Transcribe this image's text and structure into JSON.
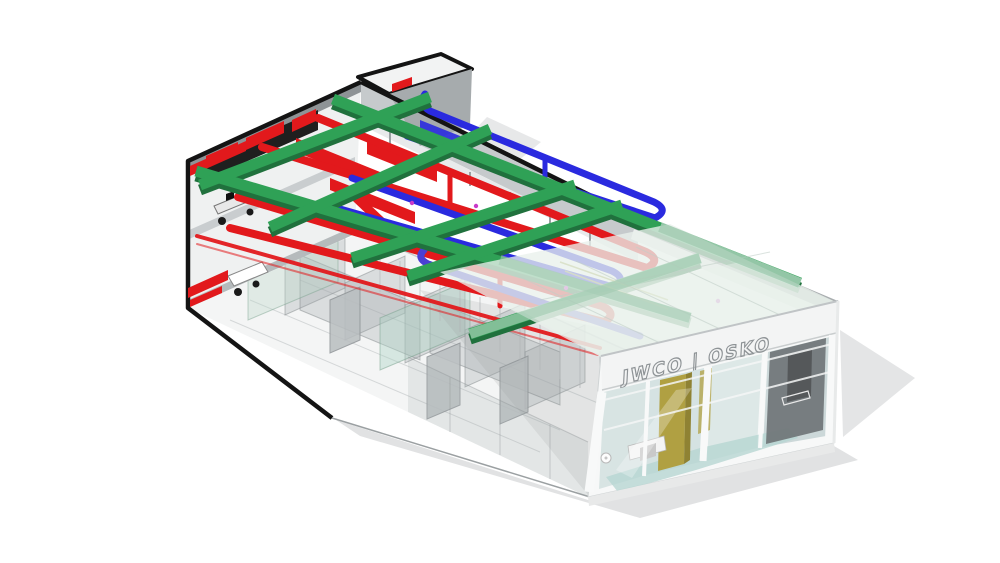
{
  "scene": {
    "background": "#ffffff",
    "description": "Axonometric cutaway BIM rendering of a commercial building with exposed structural beam grid, red ductwork and blue pipework over a ghosted interior, ending in a glazed storefront",
    "view": "isometric-cutaway"
  },
  "storefront": {
    "logo_text": "JWCO | OSKO"
  },
  "systems": {
    "structure": {
      "label": "beam-grid",
      "green": "#2FA156",
      "green_dark": "#20713D",
      "green_pale": "#A5CCB4"
    },
    "hvac": {
      "label": "ductwork",
      "red": "#E2191C"
    },
    "piping": {
      "label": "pipework",
      "blue": "#2A2ADF",
      "indigo": "#4A3FD4"
    },
    "shell": {
      "outline": "#141414",
      "wall": "#C6CACC",
      "parapet": "#A8ADAF",
      "poche": "#8E9396",
      "ceiling_void": "#1F1F1F"
    },
    "glazing": {
      "glass": "#D8E4E3",
      "roof_overlay": "#E9F1EC"
    },
    "finishes": {
      "olive": "#B0A042",
      "olive_dark": "#8F8233",
      "teal_floor": "#B7D6D2",
      "magenta_fixture": "#C93BC9",
      "cable_tray": "#9AA03A"
    },
    "ground": {
      "shadow": "#E1E2E3"
    }
  }
}
